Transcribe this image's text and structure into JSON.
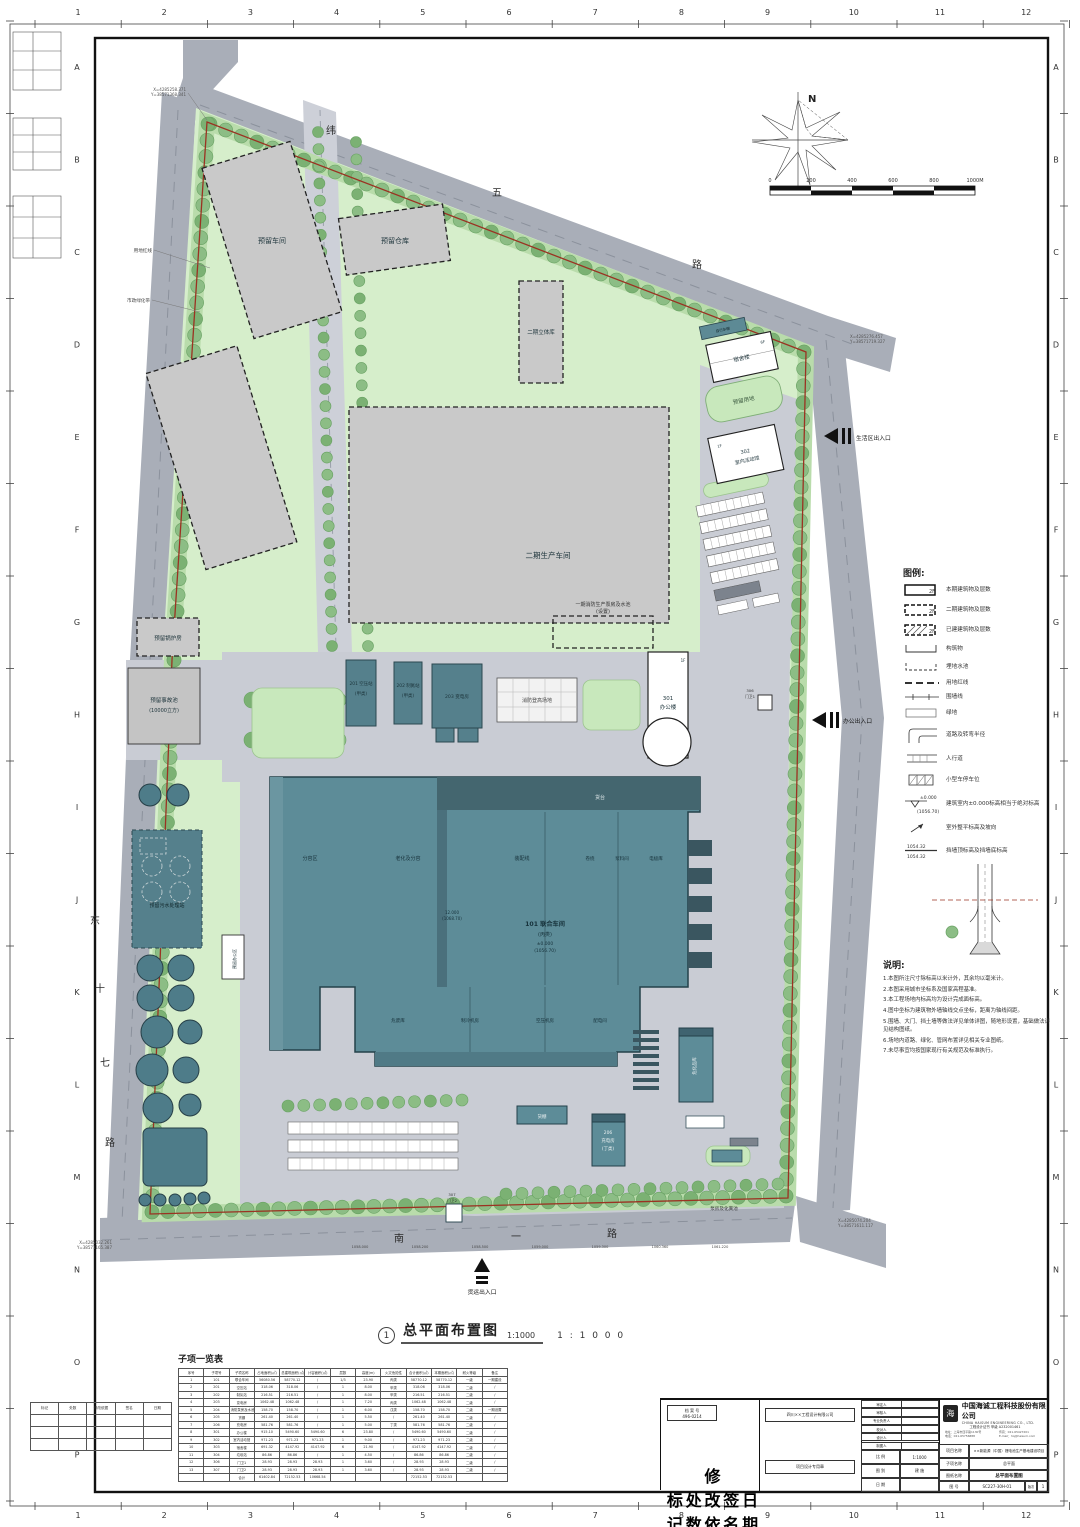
{
  "palette": {
    "road": "#a9aeb8",
    "site_green": "#d6eecb",
    "perimeter_green": "#b9dcab",
    "tree": "#8cbd85",
    "building_teal": "#5d8c98",
    "building_dark": "#3f6370",
    "reserved_grey": "#c9c9c9",
    "pavement": "#c9ccd4",
    "red_line": "#9b3222",
    "white_building": "#ffffff"
  },
  "frame": {
    "cols": [
      "1",
      "2",
      "3",
      "4",
      "5",
      "6",
      "7",
      "8",
      "9",
      "10",
      "11",
      "12"
    ],
    "rows": [
      "A",
      "B",
      "C",
      "D",
      "E",
      "F",
      "G",
      "H",
      "I",
      "J",
      "K",
      "L",
      "M",
      "N",
      "O",
      "P"
    ]
  },
  "roads": {
    "weiwu": [
      "纬",
      "五",
      "路"
    ],
    "dongshiqi": [
      "东",
      "十",
      "七",
      "路"
    ],
    "nanyi": [
      "南",
      "一",
      "路"
    ]
  },
  "compass": {
    "n": "N"
  },
  "scalebar": {
    "labels": [
      "0",
      "200",
      "400",
      "600",
      "800",
      "1000M"
    ]
  },
  "plan": {
    "buildings": {
      "b_reserved_ws1": "预留车间",
      "b_reserved_wh": "预留仓库",
      "b_p2_cube": "二期立体库",
      "b_p2_prod": "二期生产车间",
      "b_boiler": "预留锅炉房",
      "b_pool1": "预留事故池",
      "b_pool1b": "(10000立方)",
      "b_sewage": "预留污水处理站",
      "b_reserved_office": "预留办公区",
      "b_201": "201 空压站",
      "b_201b": "(甲类)",
      "b_202": "202 制氮站",
      "b_202b": "(甲类)",
      "b_203": "203 变电房",
      "fire_pad": "消防登高场地",
      "fire_pump": "一期消防生产泵房及水池",
      "fire_pump2": "(设置)",
      "b_301": "301",
      "b_301b": "办公楼",
      "b_301f": "1F",
      "bike_shed": "自行车棚",
      "b_dorm": "宿舍楼",
      "b_dorm_f": "6F",
      "b_reserved_land": "预留用地",
      "b_302": "302",
      "b_302b": "室内活动馆",
      "b_302f": "1F",
      "b_101": "101 联合车间",
      "b_101b": "(丙类)",
      "b_101c": "±0.000",
      "b_101d": "(1056.70)",
      "b_101e": "12.000",
      "b_101f": "(1068.70)",
      "dock": "货台",
      "z1": "分容区",
      "z2": "老化及分容",
      "z3": "装配线",
      "z4": "卷绕",
      "z5": "浆料间",
      "z6": "电极库",
      "s1": "危废库",
      "s2": "制冷机房",
      "s3": "空压机房",
      "s4": "配电间",
      "b_206": "206",
      "b_206b": "充电房",
      "b_206c": "(丁类)",
      "b_shed": "货棚",
      "b_chem": "危化品库",
      "pump_septic": "泵房及化粪池",
      "b_307": "307",
      "b_307b": "门卫2",
      "b_306": "306",
      "b_306b": "门卫1"
    },
    "entrances": {
      "office": "办公出入口",
      "living": "生活区出入口",
      "freight": "货运出入口"
    },
    "callouts": {
      "red_line": "用地红线",
      "green_belt": "市政绿化带",
      "c1a": "X=4285258.371",
      "c1b": "Y=38571368.341",
      "c2a": "X=4285276.457",
      "c2b": "Y=38571719.327",
      "c4a": "X=4285032.261",
      "c4b": "Y=38571165.387",
      "c5a": "X=4285074.204",
      "c5b": "Y=38571611.117"
    },
    "spot_levels": [
      "1058.000",
      "1058.200",
      "1058.500",
      "1059.000",
      "1059.300",
      "1060.360",
      "1061.220"
    ]
  },
  "legend": {
    "title": "图例:",
    "items": [
      "本期建筑物及层数",
      "二期建筑物及层数",
      "已建建筑物及层数",
      "构筑物",
      "埋地水池",
      "用地红线",
      "围墙线",
      "绿地",
      "道路及转弯半径",
      "人行道",
      "小型车停车位",
      "建筑室内±0.000标高相当于绝对标高",
      "室外整平标高及坡向",
      "挡墙顶标高及挡墙底标高"
    ],
    "floors": "2F",
    "elev_top": "±0.000",
    "elev_abs": "(1056.70)",
    "wall_top": "1054.32",
    "wall_bot": "1054.32"
  },
  "notes": {
    "title": "说明:",
    "items": [
      "1.本图所注尺寸除标高以米计外，其余均以毫米计。",
      "2.本图采用城市坐标系及国家高程基准。",
      "3.本工程场地内标高均为设计完成面标高。",
      "4.图中坐标为建筑物外墙轴线交点坐标，距离为轴线间距。",
      "5.围墙、大门、挡土墙等做法详见单体详图，随地形设置，基础做法详见结构图纸。",
      "6.场地内道路、绿化、管网布置详见相关专业图纸。",
      "7.未尽事宜均按国家现行有关规范及标准执行。"
    ]
  },
  "title_line": {
    "num": "1",
    "title": "总平面布置图",
    "scale1": "1:1000",
    "scale2": "1 : 1 0 0 0"
  },
  "subtable": {
    "title": "子项一览表",
    "headers": [
      "序号",
      "子项号",
      "子项名称",
      "占地面积(㎡)",
      "总建筑面积(㎡)",
      "计容面积(㎡)",
      "层数",
      "高度(m)",
      "火灾危险性",
      "合计面积(㎡)",
      "本期面积(㎡)",
      "耐火等级",
      "备注"
    ],
    "rows": [
      [
        "1",
        "101",
        "联合车间",
        "56080.56",
        "58770.12",
        "/",
        "1/3",
        "23.90",
        "丙类",
        "58770.12",
        "58770.12",
        "一级",
        "一期建设"
      ],
      [
        "2",
        "201",
        "空压站",
        "318.06",
        "318.06",
        "/",
        "1",
        "8.00",
        "甲类",
        "318.06",
        "318.06",
        "二级",
        "/"
      ],
      [
        "3",
        "202",
        "制氮站",
        "216.51",
        "216.51",
        "/",
        "1",
        "8.00",
        "甲类",
        "216.51",
        "216.51",
        "二级",
        "/"
      ],
      [
        "4",
        "203",
        "变电房",
        "1062.48",
        "1062.48",
        "/",
        "1",
        "7.20",
        "丙类",
        "1062.48",
        "1062.48",
        "二级",
        "/"
      ],
      [
        "5",
        "204",
        "消防泵房及水池",
        "158.70",
        "158.70",
        "/",
        "1",
        "6.00",
        "戊类",
        "158.70",
        "158.70",
        "二级",
        "一期设置"
      ],
      [
        "6",
        "205",
        "货棚",
        "261.40",
        "261.40",
        "/",
        "1",
        "5.50",
        "/",
        "261.40",
        "261.40",
        "二级",
        "/"
      ],
      [
        "7",
        "206",
        "充电房",
        "581.76",
        "581.76",
        "/",
        "1",
        "5.00",
        "丁类",
        "581.76",
        "581.76",
        "二级",
        "/"
      ],
      [
        "8",
        "301",
        "办公楼",
        "915.10",
        "5490.60",
        "5490.60",
        "6",
        "23.80",
        "/",
        "5490.60",
        "5490.60",
        "二级",
        "/"
      ],
      [
        "9",
        "302",
        "室内活动馆",
        "971.23",
        "971.23",
        "971.23",
        "1",
        "9.00",
        "/",
        "971.23",
        "971.23",
        "二级",
        "/"
      ],
      [
        "10",
        "303",
        "宿舍楼",
        "691.32",
        "4147.92",
        "4147.92",
        "6",
        "21.90",
        "/",
        "4147.92",
        "4147.92",
        "二级",
        "/"
      ],
      [
        "11",
        "304",
        "垃圾站",
        "86.86",
        "86.86",
        "/",
        "1",
        "4.50",
        "/",
        "86.86",
        "86.86",
        "二级",
        "/"
      ],
      [
        "12",
        "306",
        "门卫1",
        "28.93",
        "28.93",
        "28.93",
        "1",
        "3.60",
        "/",
        "28.93",
        "28.93",
        "二级",
        "/"
      ],
      [
        "13",
        "307",
        "门卫2",
        "28.93",
        "28.93",
        "28.93",
        "1",
        "3.60",
        "/",
        "28.93",
        "28.93",
        "二级",
        "/"
      ]
    ],
    "total": [
      "",
      "",
      "合计",
      "61402.84",
      "72152.53",
      "10668.54",
      "",
      "",
      "",
      "72152.53",
      "72152.53",
      "",
      ""
    ]
  },
  "revtable": {
    "headers": [
      "标记",
      "处数",
      "修改依据",
      "签名",
      "日期"
    ],
    "empty_rows": 3
  },
  "titleblock": {
    "company_cn": "中国海诚工程科技股份有限公司",
    "company_en": "CHINA HAISUM ENGINEERING CO., LTD.",
    "cert": "工程设计证书 甲级 A232001461",
    "contact1": "地址：上海市四平路1130号",
    "contact2": "电话：021-65756888",
    "contact3": "传真：021-65427201",
    "contact4": "E-mail：hq@haisum.com",
    "stamp1": "四川××工程设计有限公司",
    "stamp2": "项目设计专用章",
    "box_line1": "档 案 号",
    "box_line2": "496-0214",
    "sign_rows": [
      "审定人",
      "审核人",
      "专业负责人",
      "校对人",
      "设计人",
      "制图人"
    ],
    "scale_label": "比 例",
    "scale_value": "1:1000",
    "type_label": "图 别",
    "type_value": "建 施",
    "date_label": "日 期",
    "date_value": "",
    "project_label": "项目名称",
    "project_value": "××新能源（中国）锂电池生产基地建设项目",
    "sub_label": "子项名称",
    "sub_value": "总平面",
    "dwg_label": "图纸名称",
    "dwg_value": "总平面布置图",
    "no_label": "图 号",
    "no_value": "SC227-30H-01",
    "rev_label": "版次",
    "rev_value": "1"
  }
}
